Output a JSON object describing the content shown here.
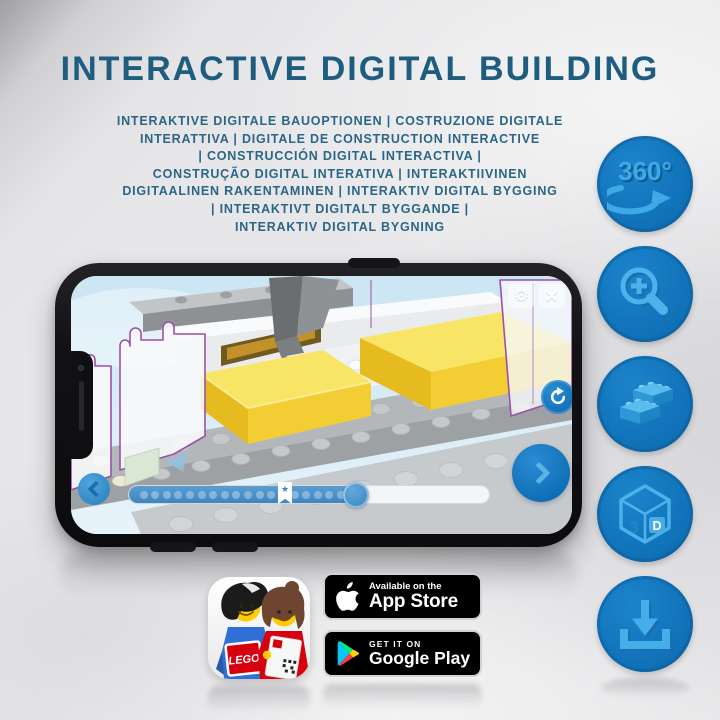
{
  "colors": {
    "accent_blue": "#1173b9",
    "glyph_light_blue": "#49b0e9",
    "title_blue": "#1f5d80",
    "progress_blue": "#4390c9",
    "lego_yellow": "#f2cd33"
  },
  "header": {
    "title": "INTERACTIVE DIGITAL BUILDING",
    "subtitle_lines": [
      "INTERAKTIVE DIGITALE BAUOPTIONEN | COSTRUZIONE DIGITALE",
      "INTERATTIVA | DIGITALE DE CONSTRUCTION INTERACTIVE",
      "| CONSTRUCCIÓN DIGITAL INTERACTIVA |",
      "CONSTRUÇÃO DIGITAL INTERATIVA | INTERAKTIIVINEN",
      "DIGITAALINEN RAKENTAMINEN | INTERAKTIV DIGITAL BYGGING",
      "| INTERAKTIVT DIGITALT BYGGANDE |",
      "INTERAKTIV DIGITAL BYGNING"
    ]
  },
  "feature_rail": {
    "rotate_label": "360°",
    "cube_left": "3",
    "cube_right": "D"
  },
  "phone": {
    "icons": {
      "gear": "⚙",
      "close": "×",
      "star": "★"
    },
    "progress": {
      "dot_count": 18,
      "fill_percent": 63
    }
  },
  "footer": {
    "app_icon_brand": "LEGO",
    "app_store": {
      "tagline": "Available on the",
      "store_name": "App Store"
    },
    "google_play": {
      "tagline": "GET IT ON",
      "store_name": "Google Play"
    }
  }
}
